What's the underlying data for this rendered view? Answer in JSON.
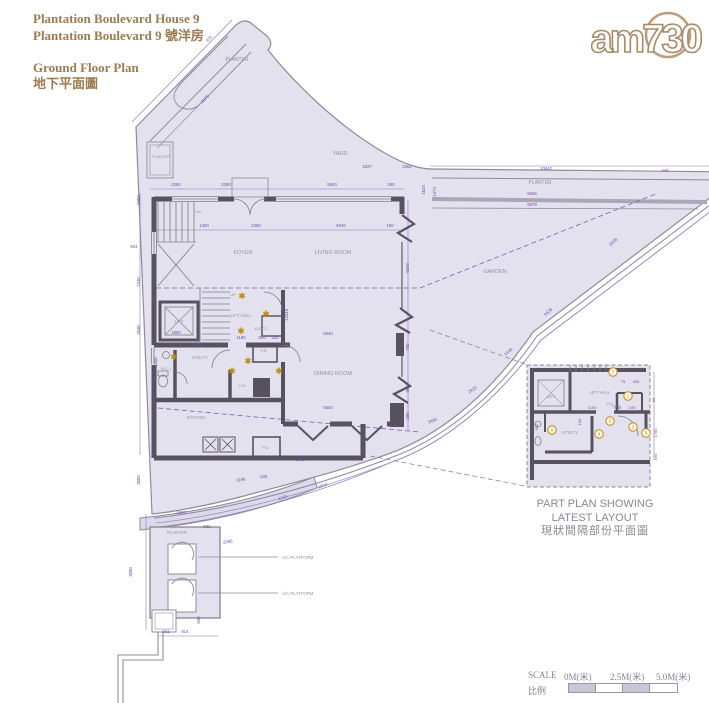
{
  "header": {
    "title_en": "Plantation Boulevard House 9",
    "title_zh": "Plantation Boulevard 9 號洋房",
    "plan_en": "Ground Floor Plan",
    "plan_zh": "地下平面圖"
  },
  "logo": {
    "text": "am730"
  },
  "colors": {
    "title": "#9c7b50",
    "fill": "#e3e1ed",
    "wall": "#57525f",
    "outline": "#8f8c99",
    "dim": "#6f4fa5",
    "label": "#95929c",
    "star": "#bf8d0e",
    "marker": "#c08a1a"
  },
  "plan": {
    "rooms": [
      {
        "label": "PLANTER",
        "x": 237,
        "y": 61,
        "size": 5
      },
      {
        "label": "PLANTER",
        "x": 161,
        "y": 158,
        "size": 3.8
      },
      {
        "label": "YARD",
        "x": 340,
        "y": 155,
        "size": 5.5
      },
      {
        "label": "PLANTER",
        "x": 540,
        "y": 184,
        "size": 5
      },
      {
        "label": "FOYER",
        "x": 243,
        "y": 254,
        "size": 5.5
      },
      {
        "label": "LIVING ROOM",
        "x": 333,
        "y": 254,
        "size": 5.5
      },
      {
        "label": "GARDEN",
        "x": 495,
        "y": 273,
        "size": 5.5
      },
      {
        "label": "LIFT",
        "x": 179,
        "y": 323,
        "size": 4.3
      },
      {
        "label": "LIFT HALL",
        "x": 241,
        "y": 317,
        "size": 4.3
      },
      {
        "label": "ELECT.",
        "x": 261,
        "y": 330,
        "size": 3.8
      },
      {
        "label": "UTILITY",
        "x": 200,
        "y": 359,
        "size": 4.3
      },
      {
        "label": "W.C.1",
        "x": 166,
        "y": 370,
        "size": 3.8
      },
      {
        "label": "H.R.",
        "x": 243,
        "y": 387,
        "size": 3.8
      },
      {
        "label": "P.D.",
        "x": 264,
        "y": 352,
        "size": 3.8
      },
      {
        "label": "DINING ROOM",
        "x": 333,
        "y": 375,
        "size": 5.5
      },
      {
        "label": "KITCHEN",
        "x": 196,
        "y": 419,
        "size": 4.3
      },
      {
        "label": "P.D.",
        "x": 266,
        "y": 449,
        "size": 3.8
      },
      {
        "label": "PLANTER",
        "x": 177,
        "y": 534,
        "size": 4.3
      },
      {
        "label": "A/C PLATFORM",
        "x": 282,
        "y": 559,
        "size": 4.3,
        "anchor": "start"
      },
      {
        "label": "A/C PLATFORM",
        "x": 282,
        "y": 595,
        "size": 4.3,
        "anchor": "start"
      },
      {
        "label": "DN",
        "x": 198,
        "y": 213,
        "size": 3.8
      },
      {
        "label": "UP",
        "x": 233,
        "y": 296,
        "size": 3.8
      }
    ],
    "stars": [
      [
        242,
        296
      ],
      [
        266,
        314
      ],
      [
        241,
        331
      ],
      [
        174,
        357
      ],
      [
        248,
        361
      ],
      [
        232,
        371
      ],
      [
        279,
        371
      ]
    ],
    "dims": [
      {
        "t": "2260",
        "x": 176,
        "y": 186
      },
      {
        "t": "2250",
        "x": 226,
        "y": 186
      },
      {
        "t": "5540",
        "x": 332,
        "y": 186
      },
      {
        "t": "260",
        "x": 391,
        "y": 186
      },
      {
        "t": "1027",
        "x": 367,
        "y": 168
      },
      {
        "t": "2362",
        "x": 407,
        "y": 168
      },
      {
        "t": "10842",
        "x": 546,
        "y": 170
      },
      {
        "t": "440",
        "x": 665,
        "y": 172
      },
      {
        "t": "9566",
        "x": 532,
        "y": 195
      },
      {
        "t": "9579",
        "x": 532,
        "y": 206
      },
      {
        "t": "1823",
        "x": 425,
        "y": 190,
        "r": -90
      },
      {
        "t": "1473",
        "x": 436,
        "y": 192,
        "r": -90
      },
      {
        "t": "1400",
        "x": 204,
        "y": 227
      },
      {
        "t": "2250",
        "x": 256,
        "y": 227
      },
      {
        "t": "5540",
        "x": 341,
        "y": 227
      },
      {
        "t": "150",
        "x": 390,
        "y": 227
      },
      {
        "t": "5584",
        "x": 140,
        "y": 200,
        "r": -90
      },
      {
        "t": "604",
        "x": 134,
        "y": 248
      },
      {
        "t": "1530",
        "x": 140,
        "y": 282,
        "r": -90
      },
      {
        "t": "3530",
        "x": 140,
        "y": 330,
        "r": -90
      },
      {
        "t": "14345",
        "x": 288,
        "y": 315,
        "r": -90
      },
      {
        "t": "6378",
        "x": 409,
        "y": 268,
        "r": -90
      },
      {
        "t": "700",
        "x": 409,
        "y": 347,
        "r": -90
      },
      {
        "t": "3572",
        "x": 409,
        "y": 388,
        "r": -90
      },
      {
        "t": "205",
        "x": 409,
        "y": 416,
        "r": -90
      },
      {
        "t": "5540",
        "x": 328,
        "y": 335
      },
      {
        "t": "5540",
        "x": 328,
        "y": 409
      },
      {
        "t": "1800",
        "x": 176,
        "y": 334
      },
      {
        "t": "1190",
        "x": 241,
        "y": 339
      },
      {
        "t": "800",
        "x": 262,
        "y": 339
      },
      {
        "t": "100",
        "x": 275,
        "y": 339
      },
      {
        "t": "2360",
        "x": 197,
        "y": 346
      },
      {
        "t": "1000",
        "x": 157,
        "y": 362,
        "r": -90
      },
      {
        "t": "375",
        "x": 210,
        "y": 40,
        "r": -45
      },
      {
        "t": "2075",
        "x": 206,
        "y": 100,
        "r": -45
      },
      {
        "t": "3536",
        "x": 614,
        "y": 243,
        "r": -42
      },
      {
        "t": "5628",
        "x": 549,
        "y": 313,
        "r": -42
      },
      {
        "t": "1548",
        "x": 509,
        "y": 353,
        "r": -38
      },
      {
        "t": "1925",
        "x": 473,
        "y": 391,
        "r": -30
      },
      {
        "t": "3486",
        "x": 433,
        "y": 422,
        "r": -22
      },
      {
        "t": "1819",
        "x": 323,
        "y": 487,
        "r": -20
      },
      {
        "t": "1133",
        "x": 283,
        "y": 499,
        "r": -18
      },
      {
        "t": "4411",
        "x": 301,
        "y": 461,
        "r": -8
      },
      {
        "t": "648",
        "x": 264,
        "y": 478,
        "r": -8
      },
      {
        "t": "1196",
        "x": 241,
        "y": 481,
        "r": -8
      },
      {
        "t": "502",
        "x": 207,
        "y": 528
      },
      {
        "t": "2266",
        "x": 228,
        "y": 543,
        "r": -10
      },
      {
        "t": "1976",
        "x": 181,
        "y": 514
      },
      {
        "t": "3000",
        "x": 140,
        "y": 480,
        "r": -90
      },
      {
        "t": "3050",
        "x": 132,
        "y": 572,
        "r": -90
      },
      {
        "t": "630",
        "x": 200,
        "y": 620,
        "r": -90
      },
      {
        "t": "561",
        "x": 166,
        "y": 633
      },
      {
        "t": "814",
        "x": 185,
        "y": 633
      }
    ]
  },
  "inset": {
    "rooms": [
      {
        "label": "LIFT",
        "x": 551,
        "y": 398,
        "size": 4.3
      },
      {
        "label": "LIFT HALL",
        "x": 600,
        "y": 394,
        "size": 4.3
      },
      {
        "label": "P.D.",
        "x": 610,
        "y": 405,
        "size": 3.8
      },
      {
        "label": "UTILITY",
        "x": 570,
        "y": 434,
        "size": 4.3
      }
    ],
    "markers": [
      {
        "n": "7",
        "x": 613,
        "y": 372
      },
      {
        "n": "1",
        "x": 628,
        "y": 396
      },
      {
        "n": "2",
        "x": 610,
        "y": 421
      },
      {
        "n": "6",
        "x": 552,
        "y": 430
      },
      {
        "n": "4",
        "x": 599,
        "y": 434
      },
      {
        "n": "3",
        "x": 633,
        "y": 427
      },
      {
        "n": "5",
        "x": 646,
        "y": 433
      }
    ],
    "dims": [
      {
        "t": "75",
        "x": 623,
        "y": 383
      },
      {
        "t": "435",
        "x": 636,
        "y": 383
      },
      {
        "t": "1190",
        "x": 592,
        "y": 409
      },
      {
        "t": "800",
        "x": 618,
        "y": 409
      },
      {
        "t": "100",
        "x": 632,
        "y": 409
      },
      {
        "t": "150",
        "x": 581,
        "y": 422,
        "r": -90
      },
      {
        "t": "1760",
        "x": 600,
        "y": 434,
        "r": -90
      },
      {
        "t": "900",
        "x": 538,
        "y": 427,
        "r": -90
      },
      {
        "t": "90",
        "x": 655,
        "y": 400,
        "r": -90
      },
      {
        "t": "1780",
        "x": 657,
        "y": 433,
        "r": -90
      },
      {
        "t": "160",
        "x": 657,
        "y": 457,
        "r": -90
      }
    ],
    "captions": [
      "PART PLAN SHOWING",
      "LATEST LAYOUT",
      "現狀間隔部份平面圖"
    ]
  },
  "scalebar": {
    "label_en": "SCALE",
    "label_zh": "比例",
    "ticks": [
      "0M(米)",
      "2.5M(米)",
      "5.0M(米)"
    ]
  }
}
